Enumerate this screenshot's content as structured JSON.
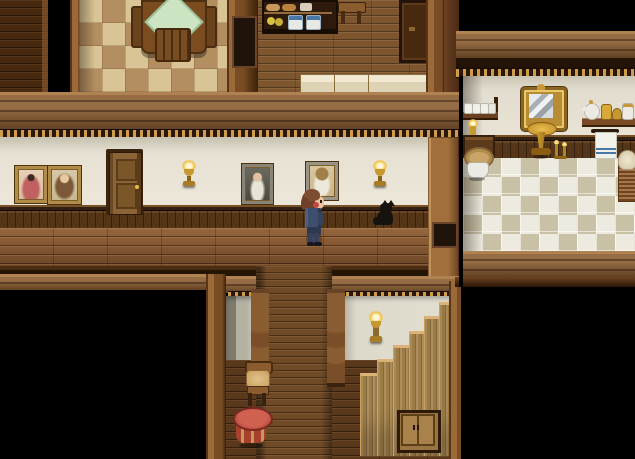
{
  "meta": {
    "type": "game-screenshot",
    "style": "top-down RPG house interior (RPG Maker style)",
    "resolution": "635x459"
  },
  "palette": {
    "void": "#000000",
    "hall_floor": "#8a5830",
    "dark_floor": "#5a381c",
    "wood_trim": "#9a6a38",
    "plaster_wall": "#e6e1d3",
    "wainscot": "#553517",
    "dentil_gold": "#cf9d4a",
    "dining_tile_light": "#d8c494",
    "dining_tile_dark": "#b28e60",
    "bath_tile_light": "#edebdf",
    "bath_tile_dark": "#c9c1a6",
    "lamp_gold": "#f0c040",
    "stool_red": "#c05040",
    "cloth_green": "#cde4c2"
  },
  "rooms": {
    "dining_room": {
      "label": "Dining room (top-left) with checkered floor and table"
    },
    "kitchen": {
      "label": "Kitchen (top-center) with food shelf and white counters"
    },
    "hallway": {
      "label": "Main hallway with portraits, lamps and wainscoting"
    },
    "bathroom": {
      "label": "Bathroom (right) with mirror, toilet and tiled floor"
    },
    "stair_room": {
      "label": "Lower landing (bottom-center) with staircase going up"
    },
    "unexplored": {
      "label": "Unexplored dark area"
    }
  },
  "objects": {
    "dining_table": {
      "label": "Wooden dining table with green tablecloth"
    },
    "dining_chair": {
      "label": "Wooden dining chair"
    },
    "kitchen_shelf": {
      "label": "Kitchen shelf with bread, lemons and blue pots"
    },
    "kitchen_stool": {
      "label": "Small wooden side table"
    },
    "kitchen_cabinet": {
      "label": "Tall dark cupboard"
    },
    "kitchen_counter": {
      "label": "White kitchen counter"
    },
    "portrait_red_lady": {
      "label": "Framed portrait of a lady in red"
    },
    "portrait_girl": {
      "label": "Framed portrait of a long-haired girl"
    },
    "portrait_dark_lady": {
      "label": "Framed portrait of a lady in a dark dress"
    },
    "portrait_tan_lady": {
      "label": "Framed portrait of a fair-haired lady"
    },
    "hall_door": {
      "label": "Wooden panel door with gold knob"
    },
    "wall_lamp": {
      "label": "Gold wall lamp"
    },
    "black_cat": {
      "label": "Black cat sitting by the wainscot"
    },
    "cup_shelf": {
      "label": "Wall shelf with white cups"
    },
    "wall_candle": {
      "label": "Gold wall candle"
    },
    "toilet": {
      "label": "Toilet with wicker lid"
    },
    "mirror": {
      "label": "Ornate gold-framed mirror"
    },
    "sink": {
      "label": "Brass pedestal wash basin"
    },
    "candle_stand": {
      "label": "Small brass candle stand"
    },
    "jar_shelf": {
      "label": "Wall shelf with teapot and jars"
    },
    "towel": {
      "label": "Hanging towel with blue stripes"
    },
    "basket": {
      "label": "Laundry basket"
    },
    "staircase": {
      "label": "Wooden staircase ascending to the right"
    },
    "under_stair_cabinet": {
      "label": "Small cabinet under the stairs"
    },
    "landing_lamp": {
      "label": "Gold wall lamp on the landing"
    },
    "landing_chair": {
      "label": "Wooden chair with tan cushion"
    },
    "red_stool": {
      "label": "Round red side table"
    },
    "baluster": {
      "label": "Turned wooden railing post"
    },
    "vent_panel": {
      "label": "Dark inset wall panel"
    }
  },
  "player": {
    "label": "Player character with brown hair and navy outfit, facing right"
  }
}
